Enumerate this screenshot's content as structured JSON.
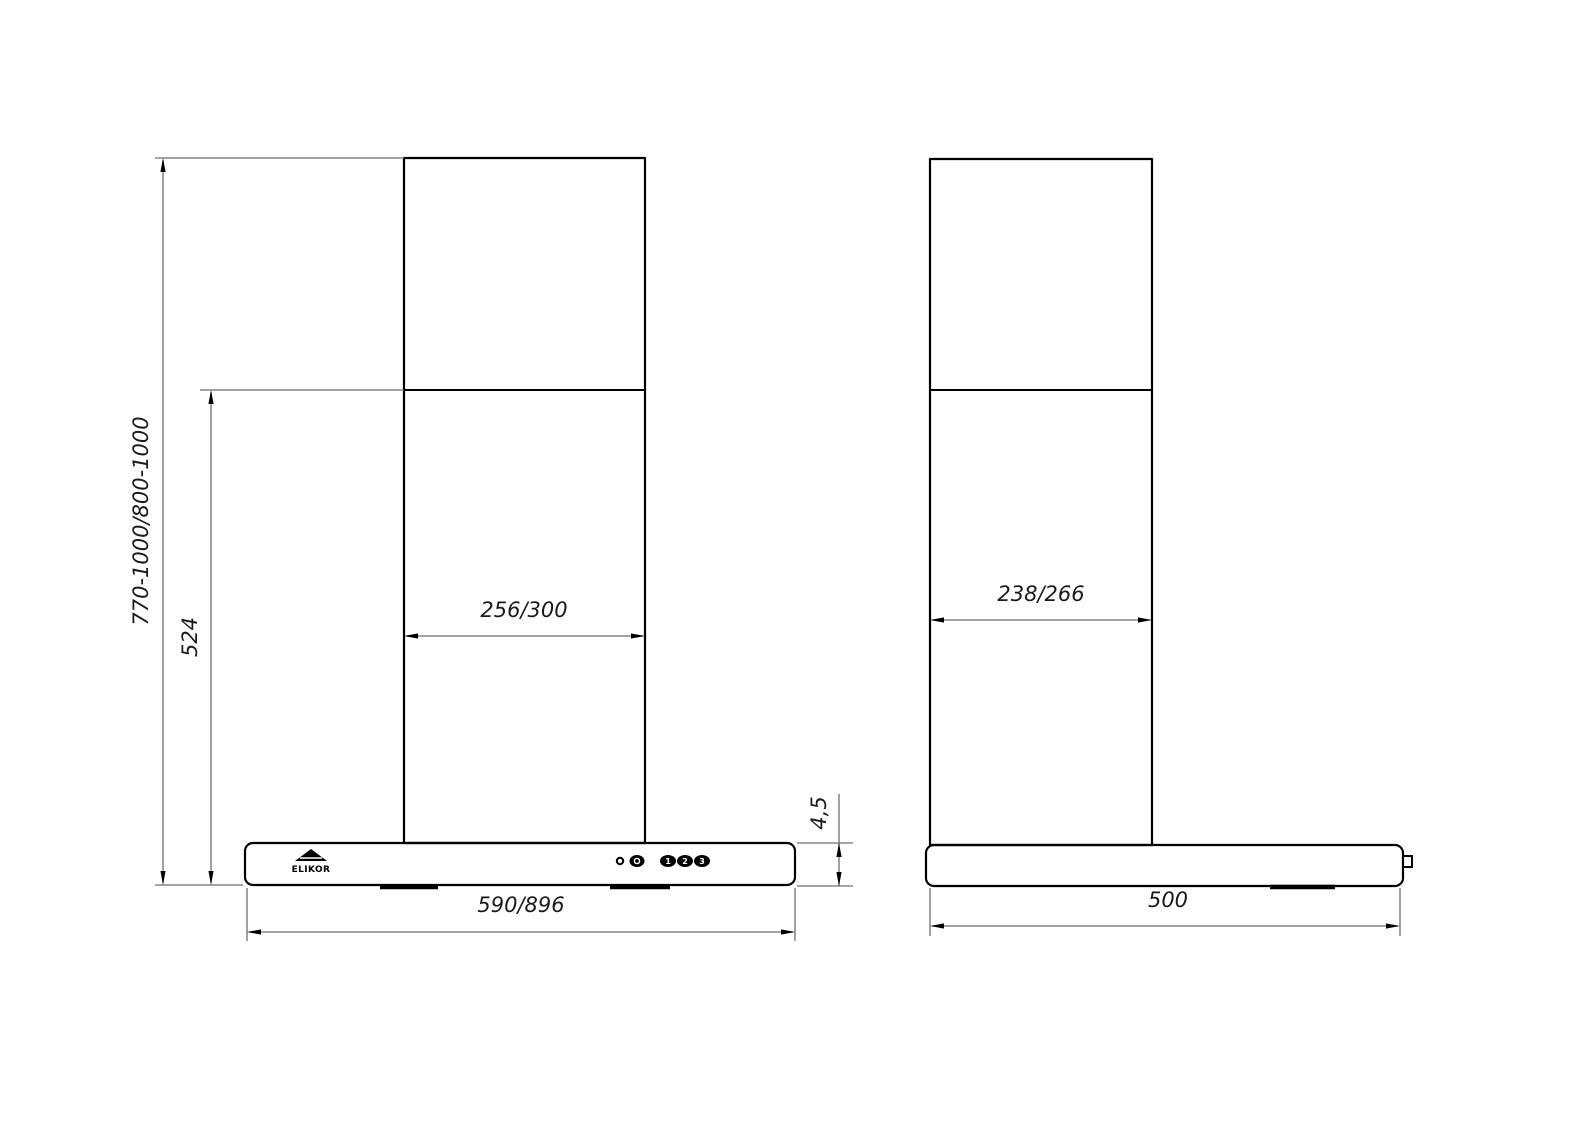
{
  "drawing": {
    "type": "technical-dimension-drawing",
    "subject": "wall-mounted kitchen cooker hood, front and side views",
    "background_color": "#ffffff",
    "outline_color": "#000000",
    "dim_line_color": "#6e6e6e"
  },
  "brand": {
    "logo_text": "ELIKOR"
  },
  "controls": {
    "indicator": "power-led",
    "light_button": "light",
    "speed_buttons": [
      "1",
      "2",
      "3"
    ]
  },
  "dimensions": {
    "front": {
      "mounting_height": "770-1000/800-1000",
      "chimney_height": "524",
      "chimney_width": "256/300",
      "body_width": "590/896",
      "body_height": "4,5"
    },
    "side": {
      "chimney_depth": "238/266",
      "body_depth": "500"
    }
  }
}
